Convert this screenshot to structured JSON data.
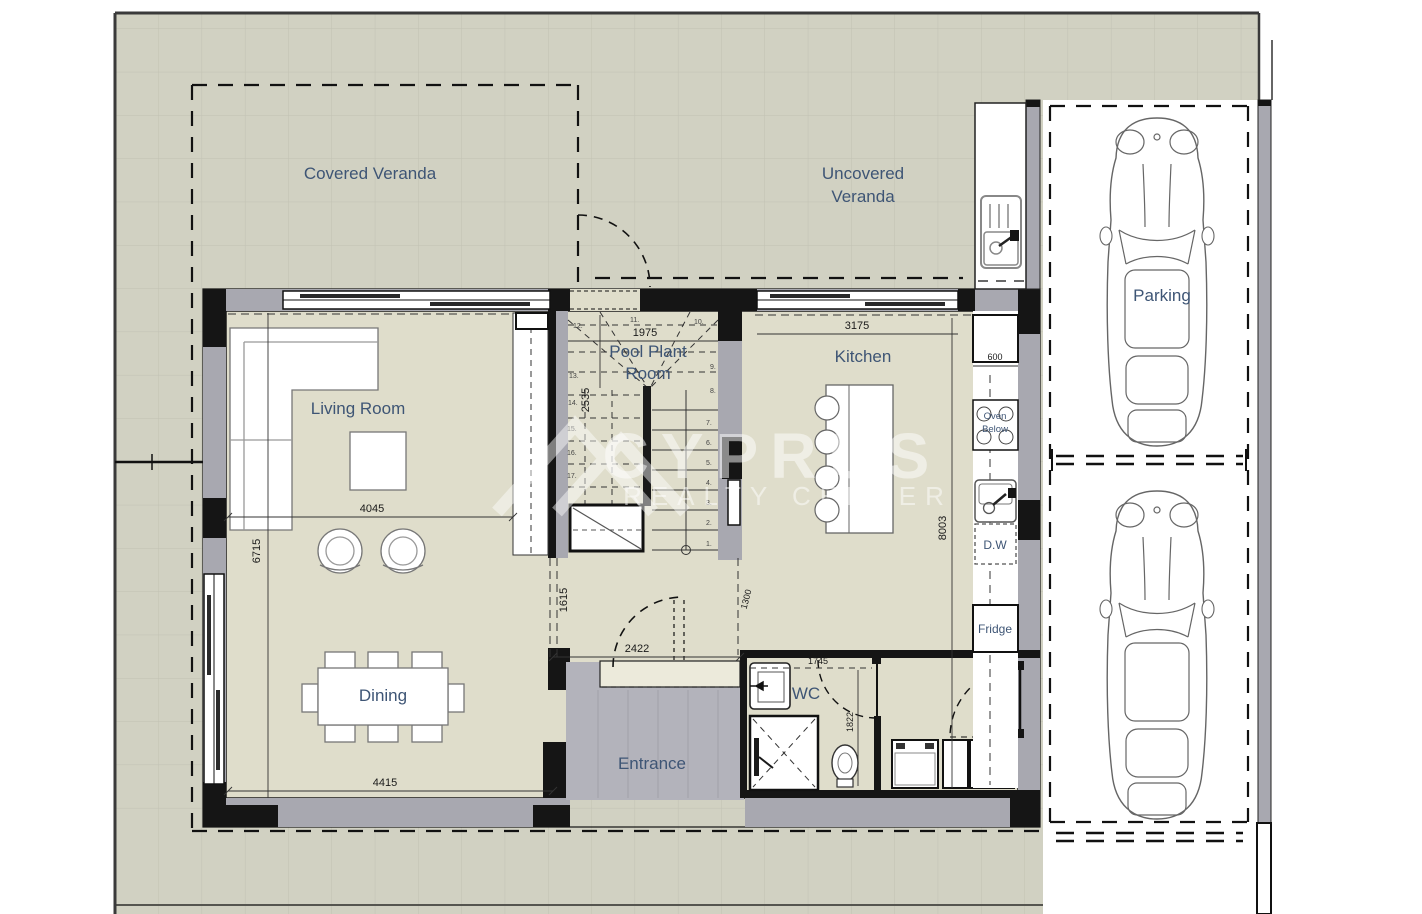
{
  "rooms": {
    "covered_veranda": "Covered Veranda",
    "uncovered_veranda": {
      "line1": "Uncovered",
      "line2": "Veranda"
    },
    "living_room": "Living Room",
    "dining": "Dining",
    "kitchen": "Kitchen",
    "pool_plant": {
      "line1": "Pool Plant",
      "line2": "Room"
    },
    "entrance": "Entrance",
    "wc": "WC",
    "parking": "Parking"
  },
  "kitchen_items": {
    "oven": {
      "line1": "Oven",
      "line2": "Below"
    },
    "dishwasher": "D.W",
    "fridge": "Fridge"
  },
  "dims": {
    "living_w": "4045",
    "living_h": "6715",
    "dining_w": "4415",
    "hall_w": "2422",
    "hall_h1": "1615",
    "hall_h2": "1300",
    "pool_w": "1975",
    "pool_h": "2535",
    "kitchen_w": "3175",
    "kitchen_h": "8003",
    "counter": "600",
    "wc_w": "1745",
    "wc_h": "1822"
  },
  "stairs": {
    "steps_lower": [
      "1.",
      "2.",
      "3.",
      "4.",
      "5.",
      "6.",
      "7.",
      "8.",
      "9."
    ],
    "steps_upper": [
      "10.",
      "11.",
      "12.",
      "13.",
      "14.",
      "15.",
      "16.",
      "17."
    ]
  },
  "watermark": {
    "brand": "CYPRUS",
    "tagline": "REALTY CENTER"
  },
  "colors": {
    "site_tile": "#d1d1c2",
    "grid_line": "#c1c1b3",
    "floor": "#dfddcb",
    "wall": "#a8a8b0",
    "structure_black": "#151515",
    "label_blue": "#3e5575",
    "porch": "#b3b3bb",
    "watermark_white": "#ffffff"
  }
}
